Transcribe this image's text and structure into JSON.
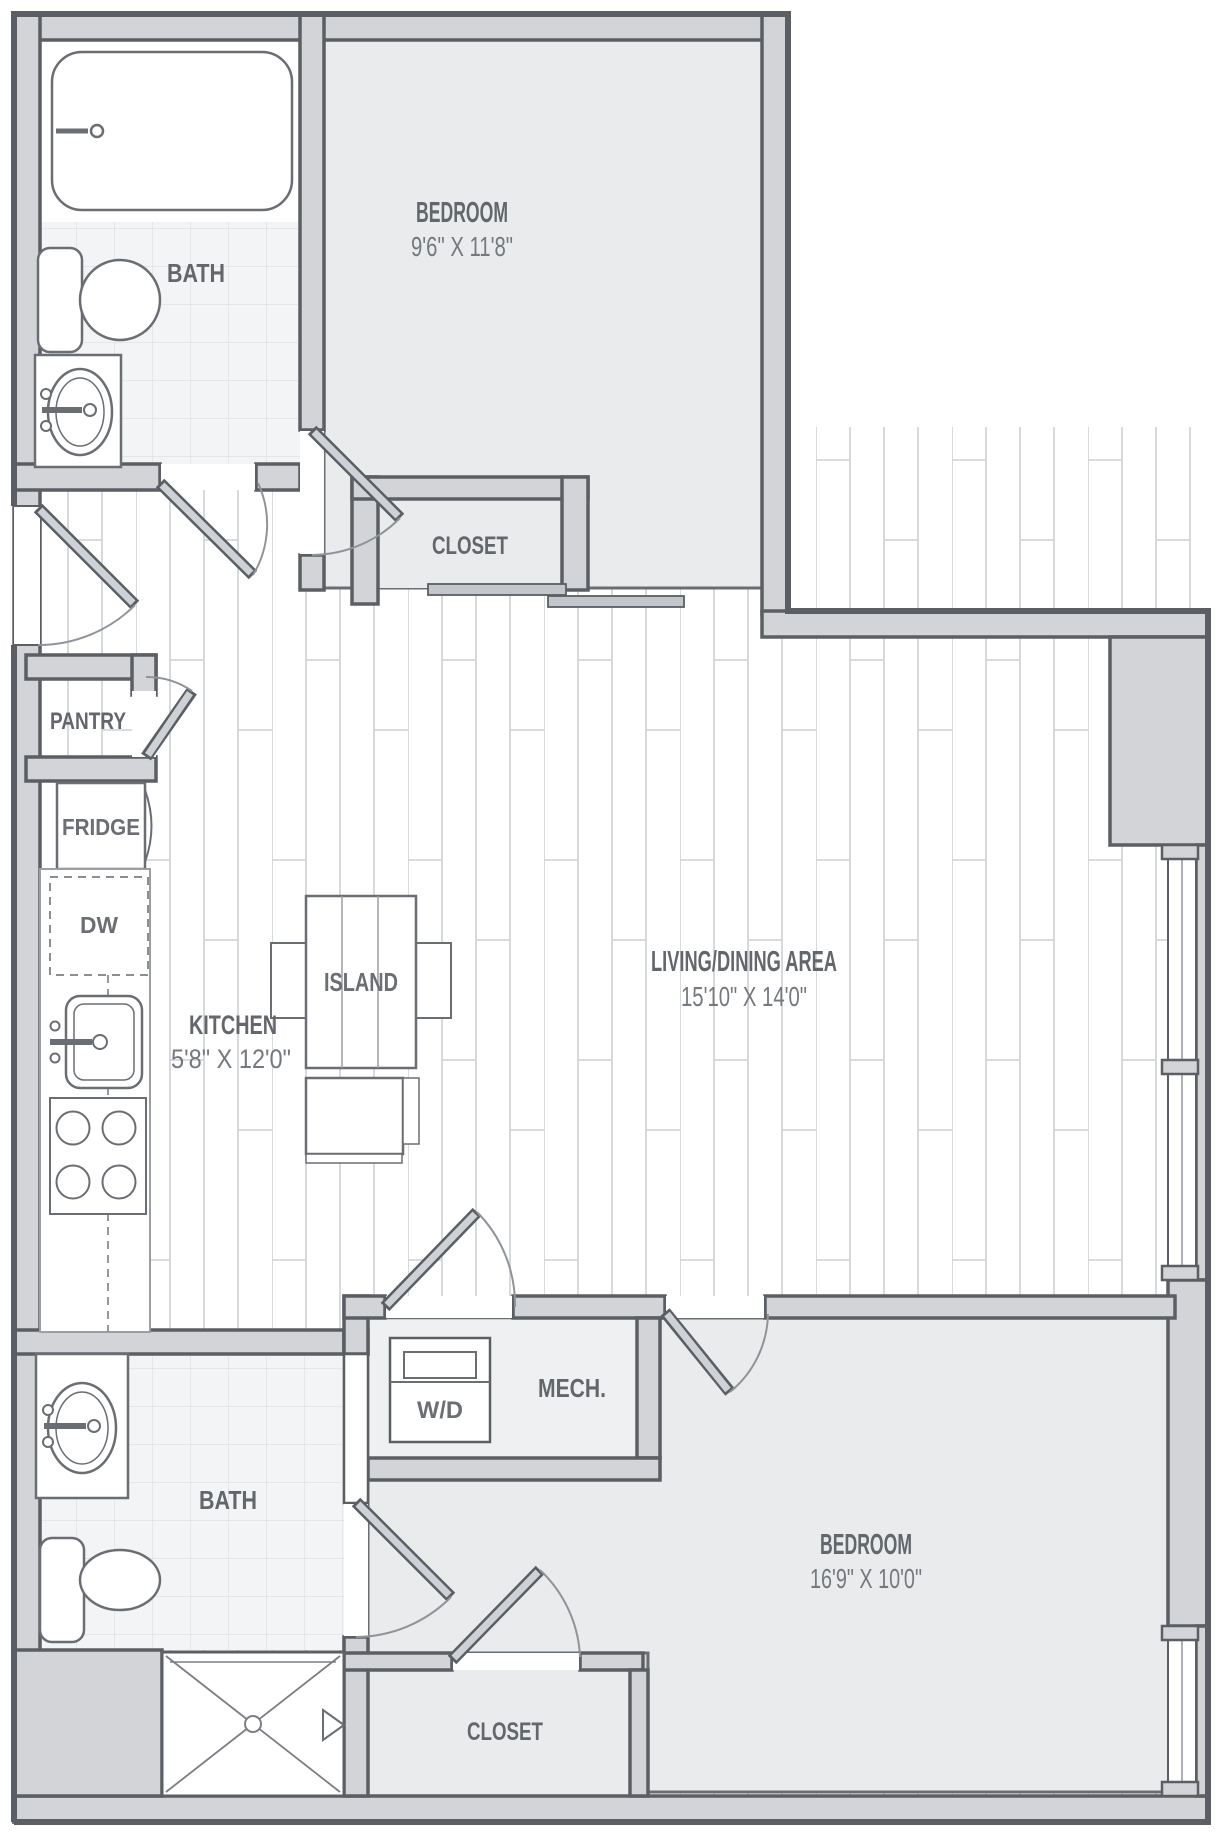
{
  "colors": {
    "wall_fill": "#d2d4d8",
    "wall_edge": "#5b5e63",
    "room_fill": "#e9ebed",
    "mech_fill": "#eff0f2",
    "tile_bg": "#f3f4f5",
    "tile_line": "#dfe1e4",
    "wood_line": "#cdd0d3",
    "label": "#63666b",
    "dimension": "#75787d"
  },
  "rooms": {
    "bath_top": {
      "label": "BATH"
    },
    "bedroom_top": {
      "label": "BEDROOM",
      "dimensions": "9'6\" X 11'8\""
    },
    "closet_top": {
      "label": "CLOSET"
    },
    "pantry": {
      "label": "PANTRY"
    },
    "kitchen": {
      "label": "KITCHEN",
      "dimensions": "5'8\" X 12'0\""
    },
    "living_dining": {
      "label": "LIVING/DINING AREA",
      "dimensions": "15'10\" X 14'0\""
    },
    "mech": {
      "label": "MECH."
    },
    "bath_bottom": {
      "label": "BATH"
    },
    "bedroom_bottom": {
      "label": "BEDROOM",
      "dimensions": "16'9\" X 10'0\""
    },
    "closet_bottom": {
      "label": "CLOSET"
    }
  },
  "fixtures": {
    "fridge": {
      "label": "FRIDGE"
    },
    "dishwasher": {
      "label": "DW"
    },
    "island": {
      "label": "ISLAND"
    },
    "washer_dryer": {
      "label": "W/D"
    }
  }
}
